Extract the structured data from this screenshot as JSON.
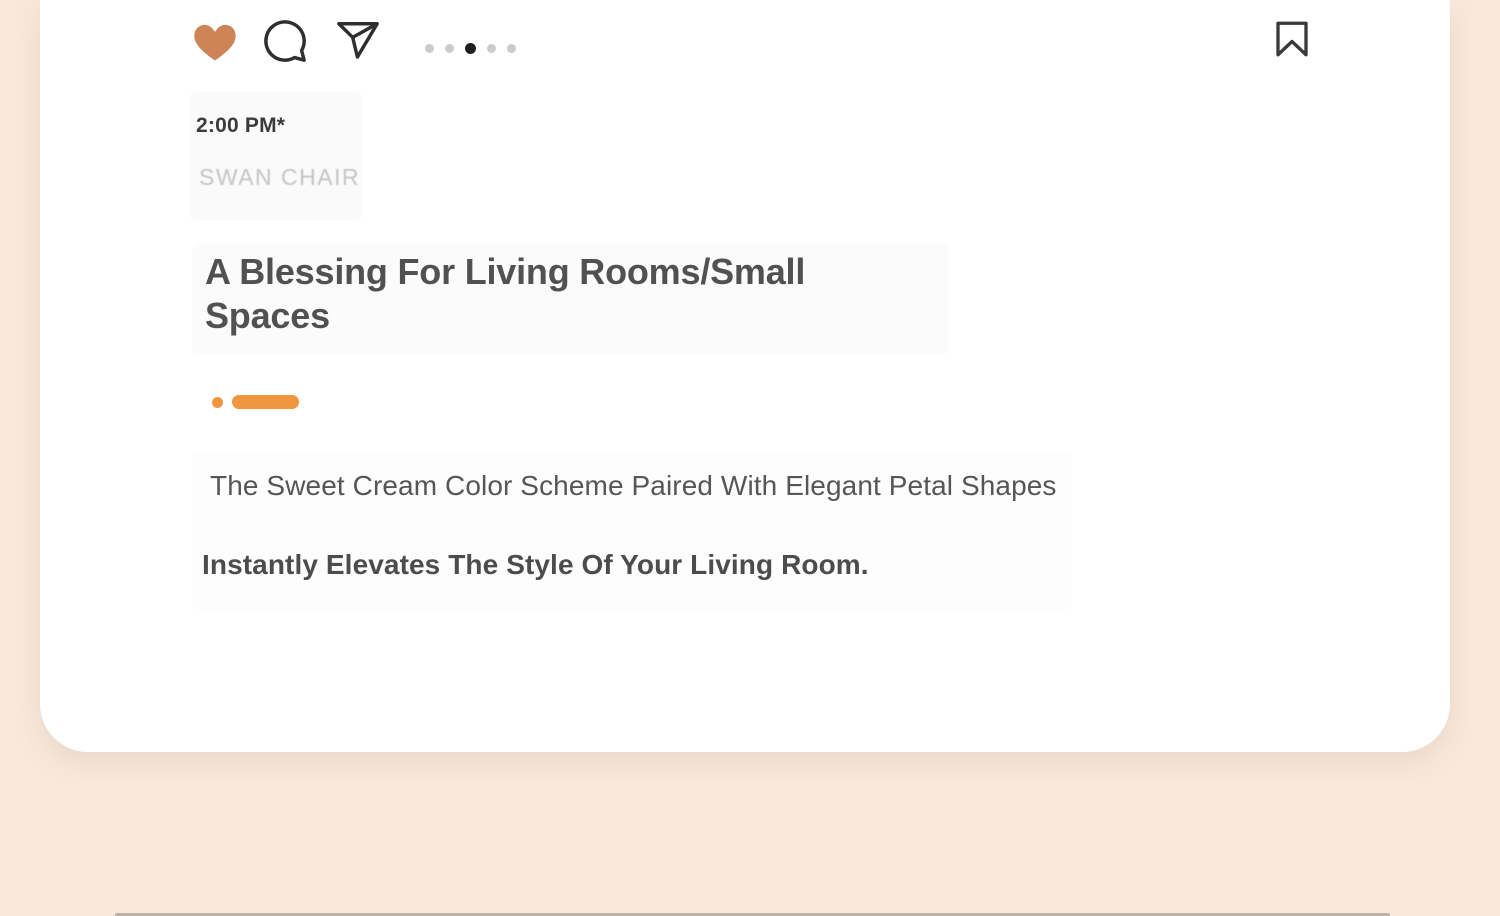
{
  "page": {
    "background_color": "#f8e9dc",
    "card_color": "#ffffff"
  },
  "post": {
    "actions": {
      "like": {
        "icon": "heart-filled-icon",
        "color": "#cf8458",
        "state": "liked"
      },
      "comment": {
        "icon": "comment-bubble-icon",
        "color": "#2f2f2f"
      },
      "share": {
        "icon": "paper-plane-icon",
        "color": "#2f2f2f"
      },
      "save": {
        "icon": "bookmark-icon",
        "color": "#3a3a3a"
      }
    },
    "carousel": {
      "total_dots": 5,
      "active_index": 2,
      "active_color": "#1f1f1f",
      "inactive_color": "#cbcbcb"
    },
    "meta": {
      "time": "2:00 PM*",
      "brand": "SWAN CHAIR"
    },
    "title": "A Blessing For Living Rooms/Small Spaces",
    "divider": {
      "accent_color": "#f0963f"
    },
    "body": {
      "line1": "The Sweet Cream Color Scheme Paired With Elegant Petal Shapes",
      "line2": "Instantly Elevates The Style Of Your Living Room."
    }
  }
}
